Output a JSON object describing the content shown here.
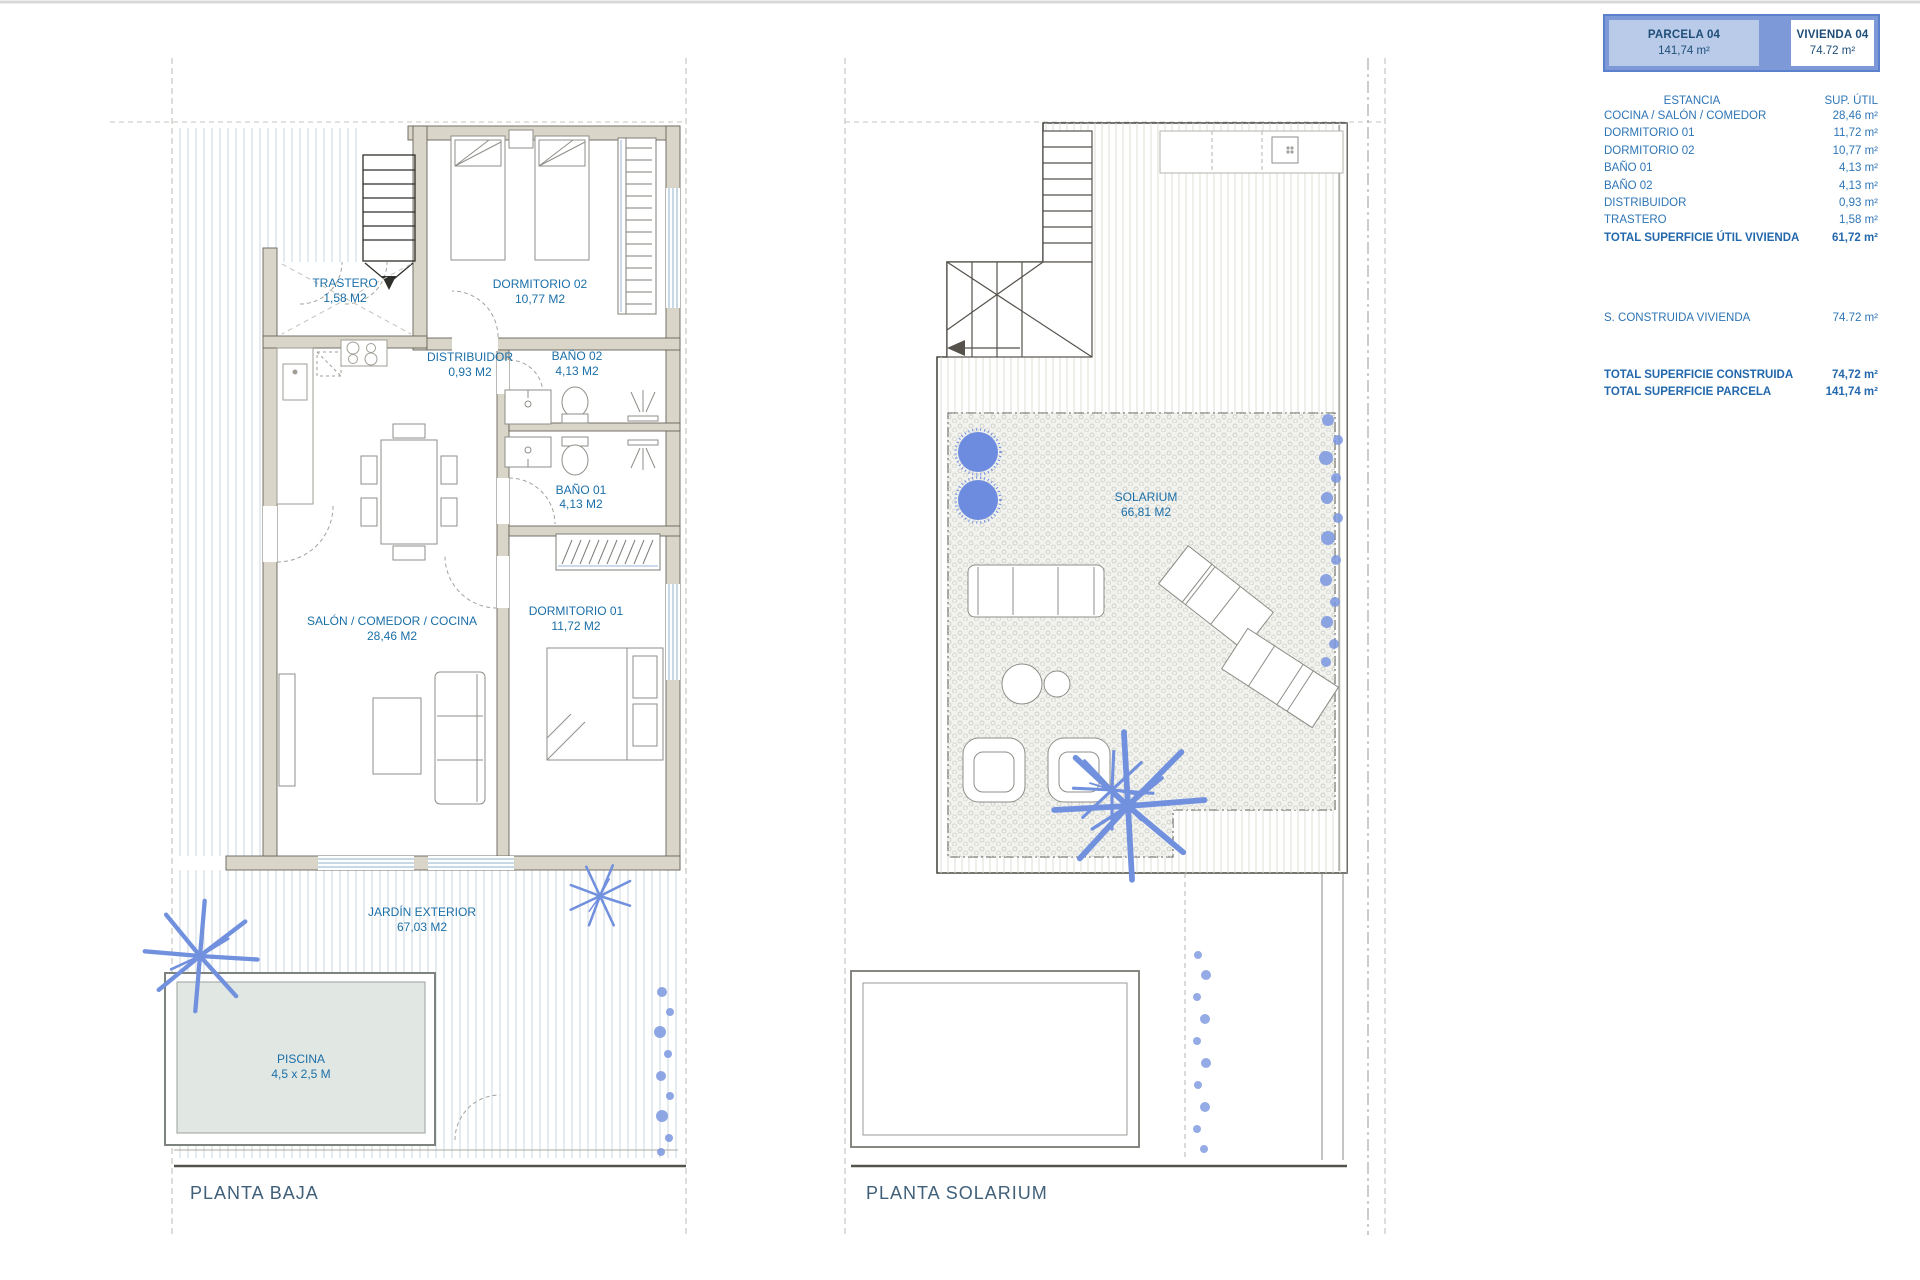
{
  "header": {
    "parcela": {
      "label": "PARCELA 04",
      "value": "141,74 m²"
    },
    "vivienda": {
      "label": "VIVIENDA 04",
      "value": "74.72 m²"
    }
  },
  "summary": {
    "col_estancia": "ESTANCIA",
    "col_sup": "SUP.  ÚTIL",
    "rows": [
      {
        "label": "COCINA / SALÓN / COMEDOR",
        "value": "28,46 m²"
      },
      {
        "label": "DORMITORIO 01",
        "value": "11,72 m²"
      },
      {
        "label": "DORMITORIO 02",
        "value": "10,77 m²"
      },
      {
        "label": "BAÑO 01",
        "value": "4,13 m²"
      },
      {
        "label": "BAÑO 02",
        "value": "4,13 m²"
      },
      {
        "label": "DISTRIBUIDOR",
        "value": "0,93 m²"
      },
      {
        "label": "TRASTERO",
        "value": "1,58 m²"
      }
    ],
    "total_util": {
      "label": "TOTAL SUPERFICIE ÚTIL VIVIENDA",
      "value": "61,72 m²"
    },
    "construida": {
      "label": "S. CONSTRUIDA VIVIENDA",
      "value": "74.72 m²"
    },
    "total_construida": {
      "label": "TOTAL SUPERFICIE CONSTRUIDA",
      "value": "74,72 m²"
    },
    "total_parcela": {
      "label": "TOTAL SUPERFICIE PARCELA",
      "value": "141,74 m²"
    }
  },
  "plans": {
    "baja": {
      "title": "PLANTA BAJA",
      "rooms": {
        "trastero": {
          "name": "TRASTERO",
          "area": "1,58 M2"
        },
        "dormitorio02": {
          "name": "DORMITORIO 02",
          "area": "10,77 M2"
        },
        "distribuidor": {
          "name": "DISTRIBUIDOR",
          "area": "0,93 M2"
        },
        "bano02": {
          "name": "BAÑO 02",
          "area": "4,13 M2"
        },
        "bano01": {
          "name": "BAÑO 01",
          "area": "4,13 M2"
        },
        "salon": {
          "name": "SALÓN / COMEDOR / COCINA",
          "area": "28,46 M2"
        },
        "dormitorio01": {
          "name": "DORMITORIO 01",
          "area": "11,72 M2"
        },
        "jardin": {
          "name": "JARDÍN EXTERIOR",
          "area": "67,03 M2"
        },
        "piscina": {
          "name": "PISCINA",
          "area": "4,5 x 2,5 M"
        }
      }
    },
    "solarium": {
      "title": "PLANTA SOLARIUM",
      "rooms": {
        "solarium": {
          "name": "SOLARIUM",
          "area": "66,81 M2"
        }
      }
    }
  },
  "colors": {
    "accent_blue": "#2e75b6",
    "navy": "#1f4e79",
    "panel_fill": "#7e99d8",
    "panel_cell": "#b9cbe9",
    "label_blue": "#1b6fa8",
    "wall_tan": "#d9d5c8",
    "plant_blue": "#7191de",
    "pool_fill": "#e1e8e4"
  }
}
